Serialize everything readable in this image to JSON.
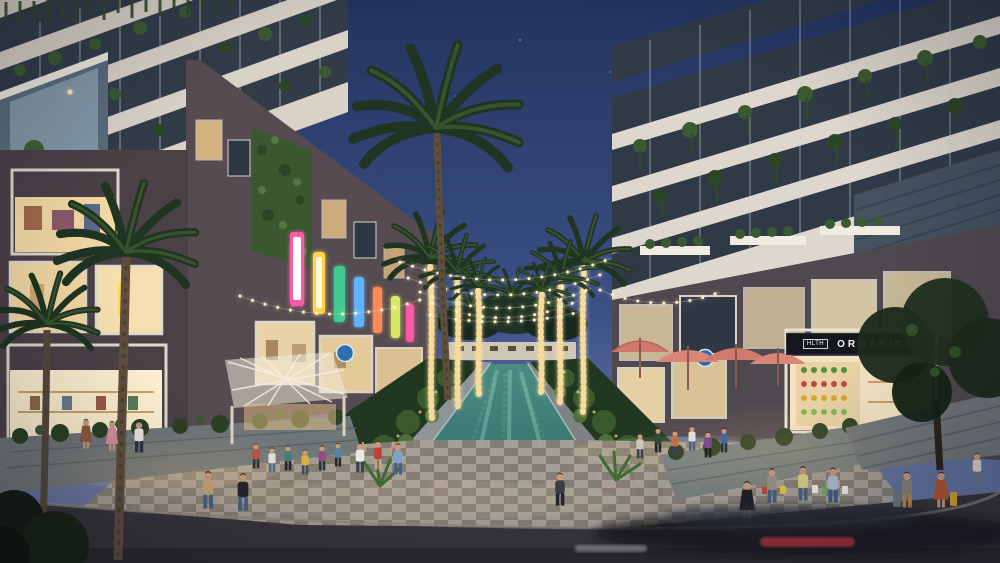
{
  "scene": {
    "description": "Dusk architectural rendering of a retail promenade: twin apartment towers with planted balconies flank a landscaped central canal lined with string-lit palm trees; shoppers stroll past lit storefronts, cafe umbrellas and flower beds; a motion-blurred car passes in the foreground road.",
    "time_of_day": "dusk",
    "style": "photorealistic real-estate rendering"
  },
  "palette": {
    "sky_top": "#22345f",
    "sky_horizon": "#5f6f9e",
    "tower_facade": "#ddd7cd",
    "podium_wall": "#4a4146",
    "window_glow": "#f6dfae",
    "canal_water": "#3c7a74",
    "foliage": "#2e4a28",
    "flower_pink": "#d37fae",
    "string_light": "#ffe2a1",
    "umbrella": "#cf7a6a",
    "road": "#37353a"
  },
  "signs": {
    "soltara_fegara": {
      "text": "Soltara Fegara"
    },
    "autumn_a": {
      "text": "Autumn"
    },
    "autumn_b": {
      "text": "Autumn"
    },
    "west": {
      "text": "WEST"
    },
    "luu_tionnive": {
      "text": "LUU TIONNIVE"
    },
    "cute_patty": {
      "text": "Cute Patty"
    },
    "bakery": {
      "text": "BAKERY"
    },
    "legacy_neon": {
      "text": "LEGACY"
    },
    "legacy_yellow": {
      "text": "LEGACY"
    },
    "legacy_gray": {
      "text": "LEGACY"
    },
    "starrier": {
      "text": "STARRIER"
    },
    "hlth": {
      "text": "HLTH"
    },
    "organics": {
      "text": "ORGANICS"
    },
    "organic_market": {
      "text": "Organic Market"
    }
  }
}
